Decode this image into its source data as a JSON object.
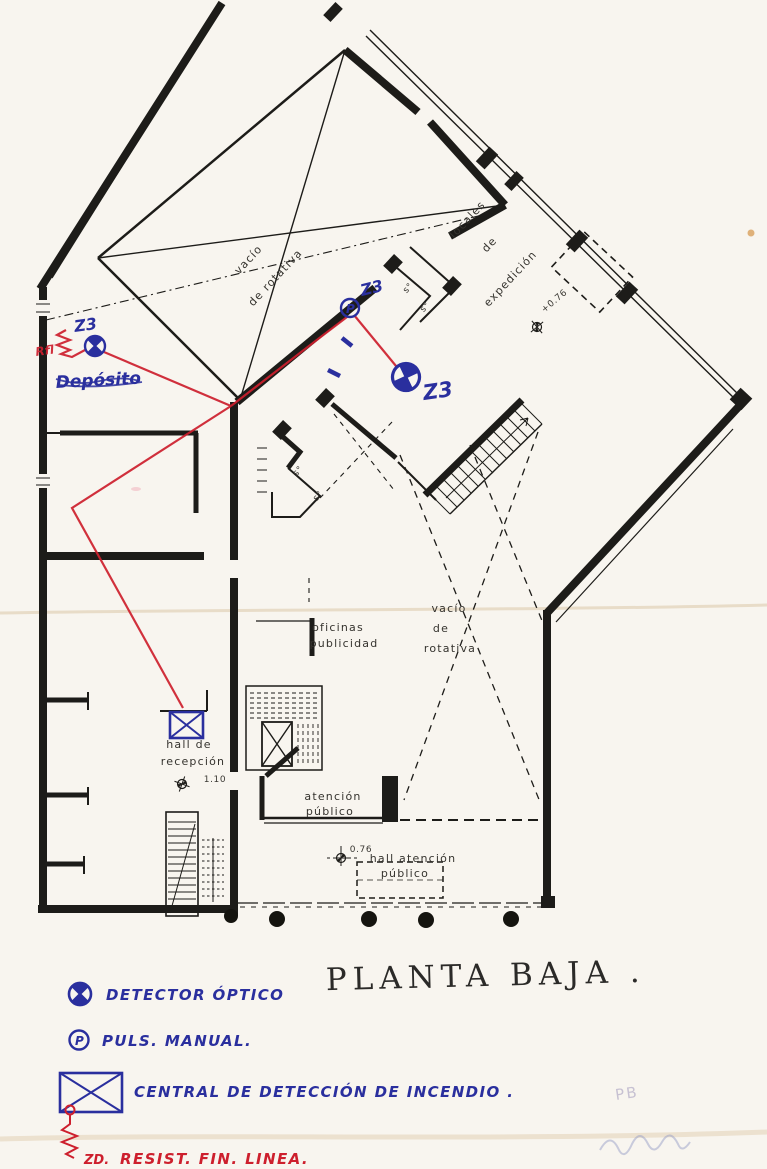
{
  "title": {
    "text": "PLANTA BAJA ."
  },
  "plan": {
    "upper_void": [
      "vacío",
      "de  rotativa"
    ],
    "locales": [
      "locales",
      "de",
      "expedición"
    ],
    "level_expedicion": "+0.76",
    "small_rooms": [
      "s°",
      "s°",
      "s°",
      "s°"
    ],
    "oficinas": [
      "oficinas",
      "publicidad"
    ],
    "lower_void": [
      "vacío",
      "de",
      "rotativa"
    ],
    "hall_recepcion": [
      "hall  de",
      "recepción"
    ],
    "level_recepcion": "1.10",
    "atencion": [
      "atención",
      "público"
    ],
    "level_hall_atencion": "0.76",
    "hall_atencion": [
      "hall  atención",
      "público"
    ]
  },
  "annotations": {
    "zones": [
      "Z3",
      "Z3",
      "Z3"
    ],
    "rfl": "Rfl",
    "deposito": "Depósito",
    "pulsador": "P"
  },
  "legend": {
    "items": [
      {
        "id": "detector-optico",
        "label": "DETECTOR ÓPTICO",
        "color": "#2a2f9e"
      },
      {
        "id": "pulsador-manual",
        "label": "PULS. MANUAL.",
        "symbol_letter": "P",
        "color": "#2a2f9e"
      },
      {
        "id": "central-deteccion",
        "label": "CENTRAL DE DETECCIÓN DE INCENDIO .",
        "color": "#2a2f9e"
      },
      {
        "id": "resistencia-fin-linea",
        "label": "RESIST. FIN. LINEA.",
        "prefix": "ZD.",
        "color": "#cd1f2d"
      }
    ]
  },
  "footer": {
    "pencil": "PB"
  },
  "colors": {
    "paper": "#f8f5ef",
    "ink": "#1d1c19",
    "blue": "#2a2f9e",
    "red": "#cd1f2d",
    "pencil": "#c7c1d2"
  }
}
